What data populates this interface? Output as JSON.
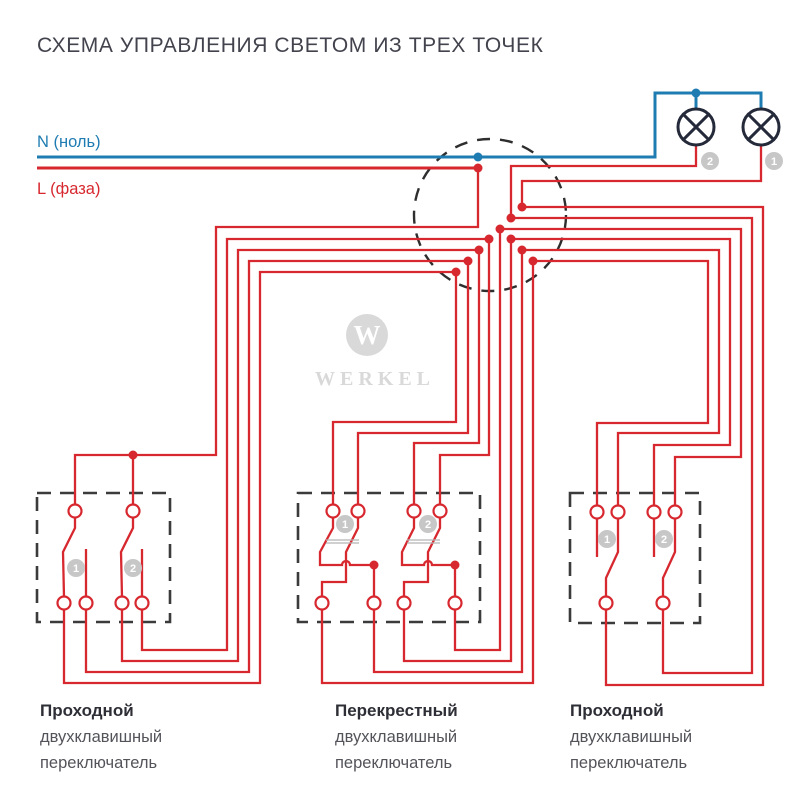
{
  "title": "СХЕМА УПРАВЛЕНИЯ СВЕТОМ ИЗ ТРЕХ ТОЧЕК",
  "colors": {
    "red": "#d7282f",
    "blue": "#1f7cb2",
    "dark": "#252a3a",
    "badge": "#c7c7c7",
    "watermark": "#d9d9d9",
    "title": "#42434d"
  },
  "power": {
    "neutral_label": "N (ноль)",
    "phase_label": "L (фаза)"
  },
  "brand": {
    "name": "WERKEL",
    "monogram": "W"
  },
  "switches": [
    {
      "label_bold": "Проходной",
      "label_line2": "двухклавишный",
      "label_line3": "переключатель"
    },
    {
      "label_bold": "Перекрестный",
      "label_line2": "двухклавишный",
      "label_line3": "переключатель"
    },
    {
      "label_bold": "Проходной",
      "label_line2": "двухклавишный",
      "label_line3": "переключатель"
    }
  ],
  "diagram": {
    "junction": {
      "cx": 490,
      "cy": 215,
      "r": 76
    },
    "boxes": [
      [
        37,
        493,
        133,
        129
      ],
      [
        298,
        493,
        182,
        129
      ],
      [
        570,
        493,
        130,
        130
      ]
    ],
    "lamps": [
      {
        "cx": 696,
        "cy": 127,
        "r": 18
      },
      {
        "cx": 761,
        "cy": 127,
        "r": 18
      }
    ],
    "blue_wires": [
      [
        [
          37,
          157
        ],
        [
          655,
          157
        ],
        [
          655,
          93
        ],
        [
          761,
          93
        ],
        [
          761,
          110
        ]
      ],
      [
        [
          696,
          93
        ],
        [
          696,
          110
        ]
      ]
    ],
    "phase_line": [
      [
        37,
        168
      ],
      [
        478,
        168
      ]
    ],
    "red_wires": [
      [
        [
          478,
          168
        ],
        [
          478,
          227
        ],
        [
          216,
          227
        ],
        [
          216,
          455
        ],
        [
          75,
          455
        ],
        [
          75,
          504
        ]
      ],
      [
        [
          133,
          455
        ],
        [
          133,
          504
        ]
      ],
      [
        [
          64,
          610
        ],
        [
          64,
          683
        ],
        [
          260,
          683
        ],
        [
          260,
          272
        ],
        [
          456,
          272
        ],
        [
          456,
          422
        ],
        [
          333,
          422
        ],
        [
          333,
          504
        ]
      ],
      [
        [
          86,
          610
        ],
        [
          86,
          672
        ],
        [
          249,
          672
        ],
        [
          249,
          261
        ],
        [
          468,
          261
        ],
        [
          468,
          433
        ],
        [
          358,
          433
        ],
        [
          358,
          504
        ]
      ],
      [
        [
          122,
          610
        ],
        [
          122,
          661
        ],
        [
          238,
          661
        ],
        [
          238,
          250
        ],
        [
          479,
          250
        ],
        [
          479,
          443
        ],
        [
          414,
          443
        ],
        [
          414,
          504
        ]
      ],
      [
        [
          142,
          610
        ],
        [
          142,
          650
        ],
        [
          227,
          650
        ],
        [
          227,
          239
        ],
        [
          489,
          239
        ],
        [
          489,
          455
        ],
        [
          440,
          455
        ],
        [
          440,
          504
        ]
      ],
      [
        [
          322,
          610
        ],
        [
          322,
          683
        ],
        [
          533,
          683
        ],
        [
          533,
          261
        ],
        [
          708,
          261
        ],
        [
          708,
          423
        ],
        [
          597,
          423
        ],
        [
          597,
          505
        ]
      ],
      [
        [
          374,
          610
        ],
        [
          374,
          672
        ],
        [
          522,
          672
        ],
        [
          522,
          250
        ],
        [
          719,
          250
        ],
        [
          719,
          433
        ],
        [
          618,
          433
        ],
        [
          618,
          505
        ]
      ],
      [
        [
          404,
          610
        ],
        [
          404,
          661
        ],
        [
          511,
          661
        ],
        [
          511,
          239
        ],
        [
          730,
          239
        ],
        [
          730,
          445
        ],
        [
          654,
          445
        ],
        [
          654,
          505
        ]
      ],
      [
        [
          455,
          610
        ],
        [
          455,
          650
        ],
        [
          500,
          650
        ],
        [
          500,
          229
        ],
        [
          741,
          229
        ],
        [
          741,
          457
        ],
        [
          675,
          457
        ],
        [
          675,
          505
        ]
      ],
      [
        [
          606,
          610
        ],
        [
          606,
          685
        ],
        [
          763,
          685
        ],
        [
          763,
          207
        ],
        [
          522,
          207
        ]
      ],
      [
        [
          663,
          610
        ],
        [
          663,
          673
        ],
        [
          752,
          673
        ],
        [
          752,
          218
        ],
        [
          511,
          218
        ]
      ],
      [
        [
          696,
          145
        ],
        [
          696,
          166
        ],
        [
          511,
          166
        ],
        [
          511,
          218
        ]
      ],
      [
        [
          761,
          145
        ],
        [
          761,
          181
        ],
        [
          522,
          181
        ],
        [
          522,
          207
        ]
      ],
      [
        [
          75,
          517
        ],
        [
          75,
          528
        ],
        [
          63,
          552
        ],
        [
          64,
          597
        ]
      ],
      [
        [
          86,
          597
        ],
        [
          86,
          549
        ]
      ],
      [
        [
          133,
          517
        ],
        [
          133,
          528
        ],
        [
          121,
          552
        ],
        [
          122,
          597
        ]
      ],
      [
        [
          142,
          597
        ],
        [
          142,
          549
        ]
      ],
      [
        [
          597,
          518
        ],
        [
          597,
          557
        ]
      ],
      [
        [
          618,
          518
        ],
        [
          618,
          552
        ],
        [
          606,
          578
        ],
        [
          606,
          597
        ]
      ],
      [
        [
          654,
          518
        ],
        [
          654,
          557
        ]
      ],
      [
        [
          675,
          518
        ],
        [
          675,
          552
        ],
        [
          663,
          578
        ],
        [
          663,
          597
        ]
      ],
      [
        [
          358,
          517
        ],
        [
          358,
          528
        ],
        [
          346,
          552
        ],
        [
          346,
          582
        ],
        [
          322,
          582
        ],
        [
          322,
          597
        ]
      ],
      [
        [
          440,
          517
        ],
        [
          440,
          528
        ],
        [
          428,
          552
        ],
        [
          428,
          582
        ],
        [
          404,
          582
        ],
        [
          404,
          597
        ]
      ]
    ],
    "red_paths": [
      "M333,517 L333,528 L320,552 L320,565 L342,565 A4,4 0 0 1 350,565 L374,565 L374,597",
      "M414,517 L414,528 L402,552 L402,565 L424,565 A4,4 0 0 1 432,565 L455,565 L455,597"
    ],
    "coupler_lines": [
      [
        [
          326,
          540
        ],
        [
          359,
          540
        ]
      ],
      [
        [
          326,
          543
        ],
        [
          359,
          543
        ]
      ],
      [
        [
          407,
          540
        ],
        [
          440,
          540
        ]
      ],
      [
        [
          407,
          543
        ],
        [
          440,
          543
        ]
      ]
    ],
    "terminals": [
      [
        75,
        511
      ],
      [
        133,
        511
      ],
      [
        64,
        603
      ],
      [
        86,
        603
      ],
      [
        122,
        603
      ],
      [
        142,
        603
      ],
      [
        333,
        511
      ],
      [
        358,
        511
      ],
      [
        414,
        511
      ],
      [
        440,
        511
      ],
      [
        322,
        603
      ],
      [
        374,
        603
      ],
      [
        404,
        603
      ],
      [
        455,
        603
      ],
      [
        597,
        512
      ],
      [
        618,
        512
      ],
      [
        654,
        512
      ],
      [
        675,
        512
      ],
      [
        606,
        603
      ],
      [
        663,
        603
      ]
    ],
    "red_dots": [
      [
        478,
        168
      ],
      [
        511,
        218
      ],
      [
        522,
        207
      ],
      [
        500,
        229
      ],
      [
        489,
        239
      ],
      [
        479,
        250
      ],
      [
        468,
        261
      ],
      [
        456,
        272
      ],
      [
        511,
        239
      ],
      [
        522,
        250
      ],
      [
        533,
        261
      ],
      [
        133,
        455
      ],
      [
        374,
        565
      ],
      [
        455,
        565
      ]
    ],
    "blue_dots": [
      [
        478,
        157
      ],
      [
        696,
        93
      ]
    ],
    "badges": [
      {
        "x": 710,
        "y": 161,
        "n": "2"
      },
      {
        "x": 774,
        "y": 161,
        "n": "1"
      },
      {
        "x": 76,
        "y": 568,
        "n": "1"
      },
      {
        "x": 133,
        "y": 568,
        "n": "2"
      },
      {
        "x": 345,
        "y": 524,
        "n": "1"
      },
      {
        "x": 428,
        "y": 524,
        "n": "2"
      },
      {
        "x": 607,
        "y": 539,
        "n": "1"
      },
      {
        "x": 664,
        "y": 539,
        "n": "2"
      }
    ]
  }
}
